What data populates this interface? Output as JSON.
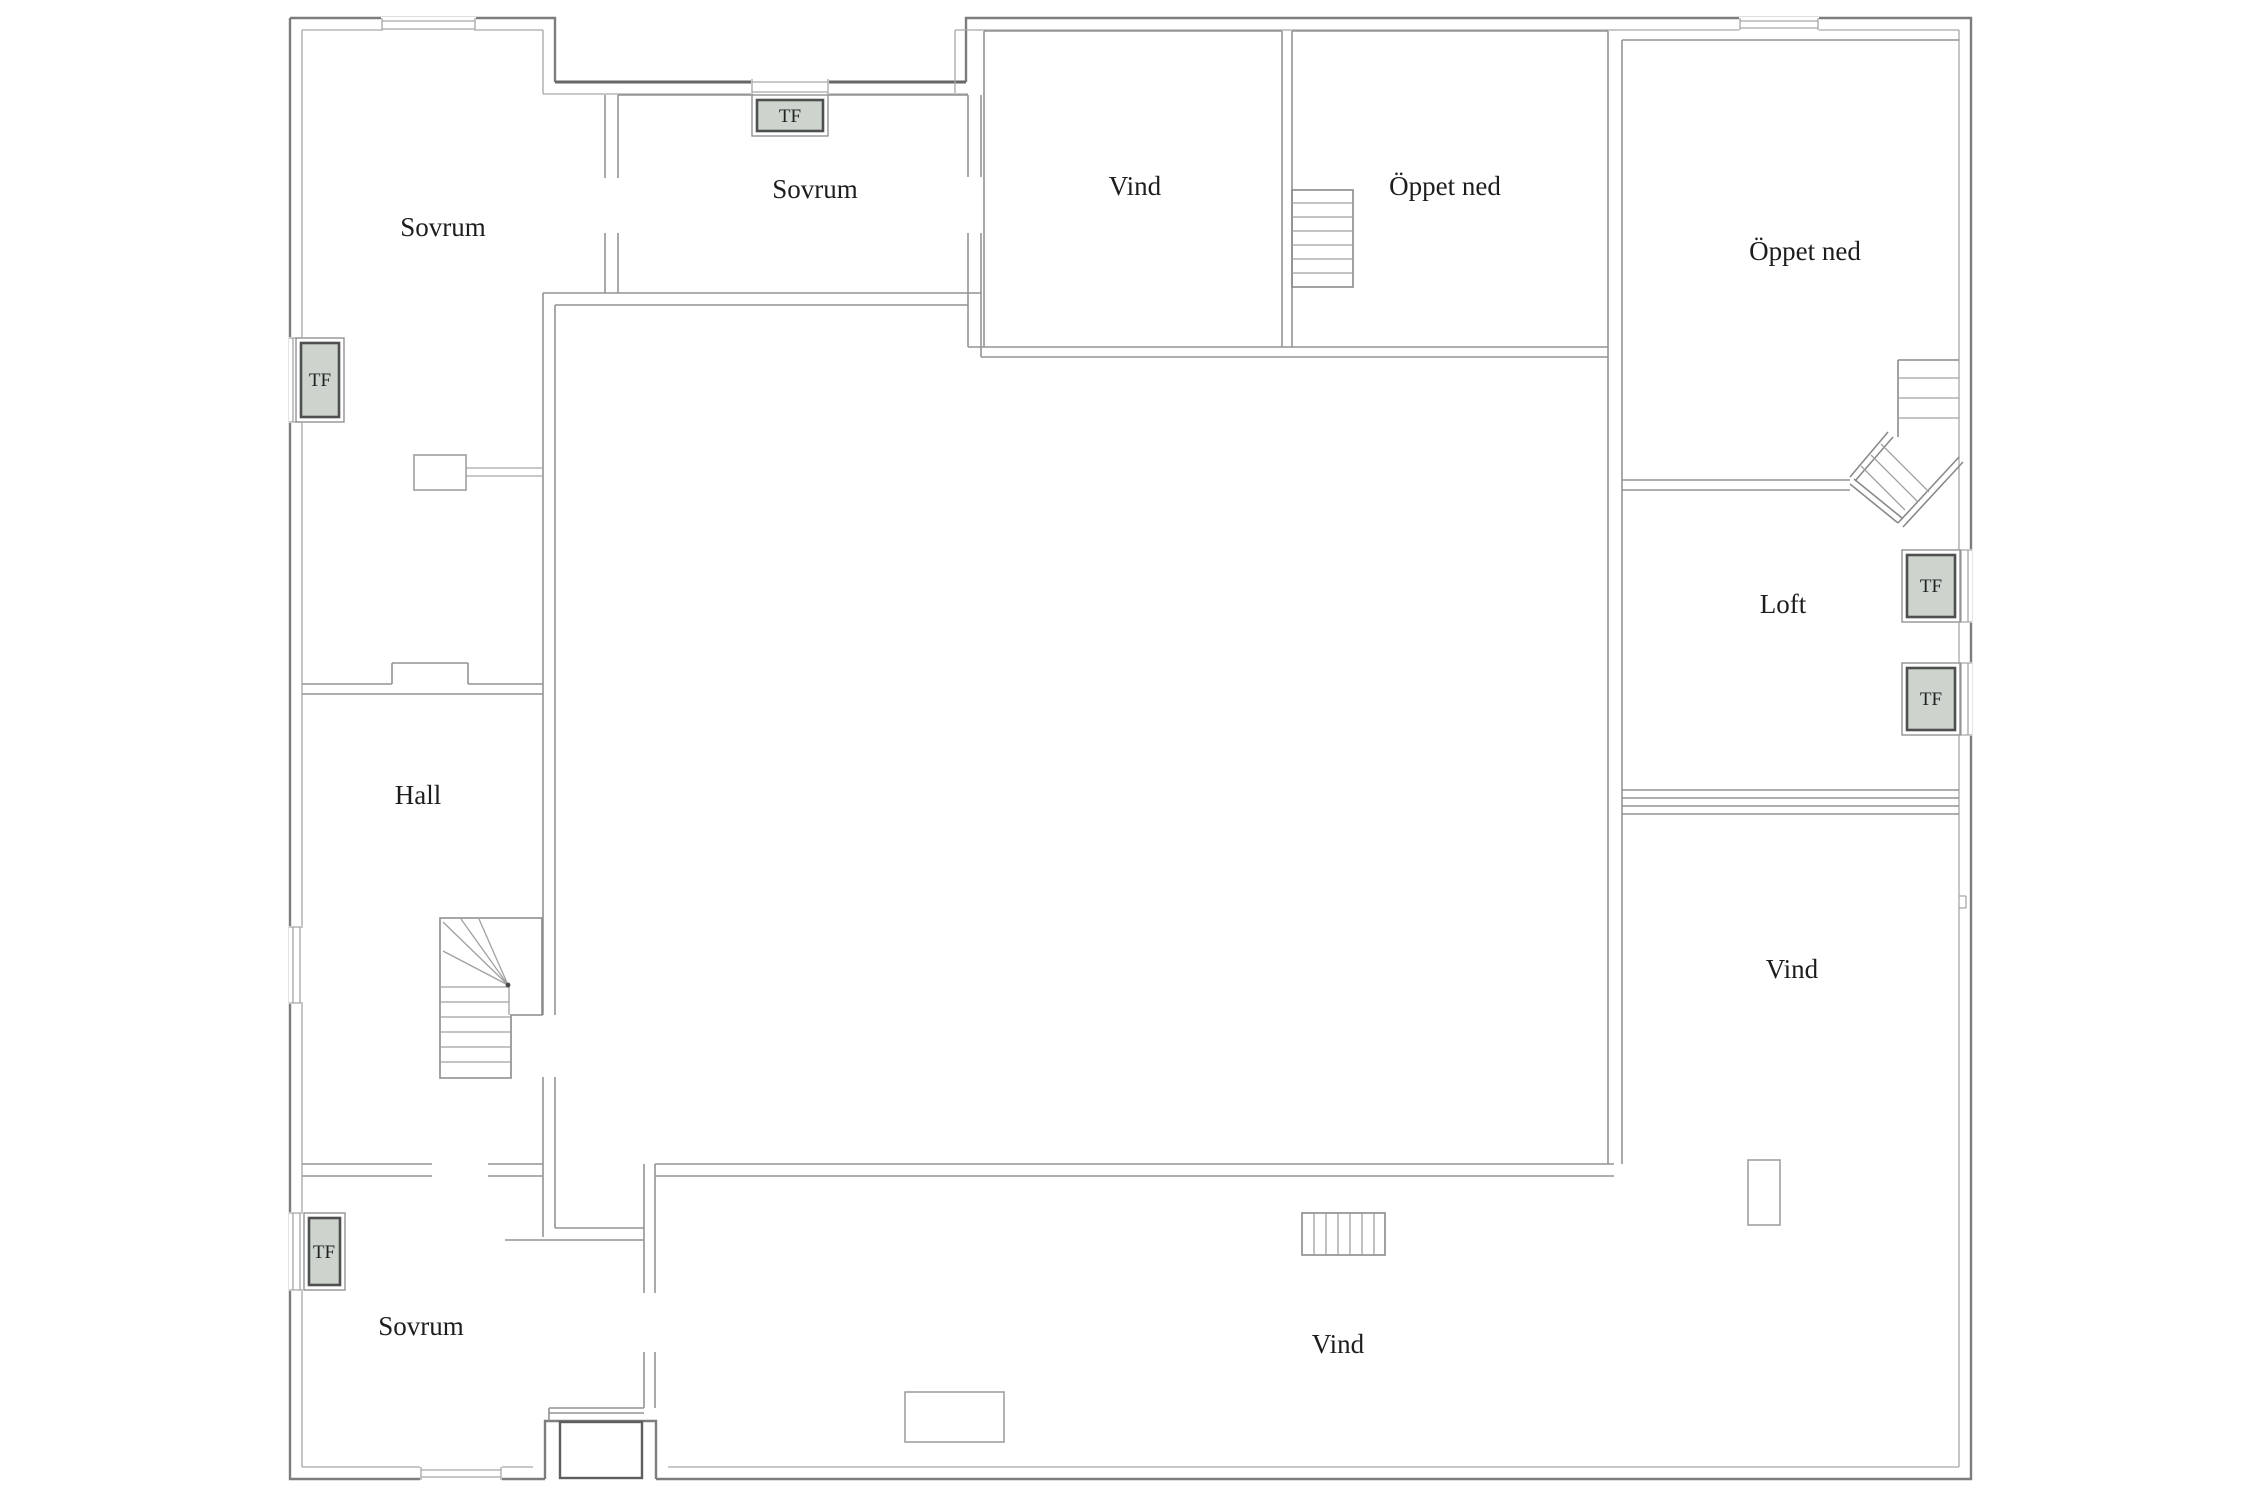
{
  "floorplan": {
    "colors": {
      "wall": "#949494",
      "outline": "#7d7d7d",
      "dark_accent": "#666666",
      "skylight_fill": "#cdd4cd",
      "text": "#1d1d1d"
    },
    "rooms": [
      {
        "id": "sovrum-top-left",
        "label": "Sovrum",
        "x": 443,
        "y": 236
      },
      {
        "id": "sovrum-top-mid",
        "label": "Sovrum",
        "x": 815,
        "y": 198
      },
      {
        "id": "vind-top",
        "label": "Vind",
        "x": 1135,
        "y": 195
      },
      {
        "id": "oppet-ned-top",
        "label": "Öppet ned",
        "x": 1445,
        "y": 195
      },
      {
        "id": "oppet-ned-right",
        "label": "Öppet ned",
        "x": 1805,
        "y": 260
      },
      {
        "id": "loft",
        "label": "Loft",
        "x": 1783,
        "y": 613
      },
      {
        "id": "hall",
        "label": "Hall",
        "x": 418,
        "y": 804
      },
      {
        "id": "sovrum-bottom",
        "label": "Sovrum",
        "x": 421,
        "y": 1335
      },
      {
        "id": "vind-bottom",
        "label": "Vind",
        "x": 1338,
        "y": 1353
      },
      {
        "id": "vind-right",
        "label": "Vind",
        "x": 1792,
        "y": 978
      }
    ],
    "skylights": [
      {
        "id": "tf-left-top",
        "label": "TF",
        "x": 320,
        "y": 386
      },
      {
        "id": "tf-top-mid",
        "label": "TF",
        "x": 790,
        "y": 122
      },
      {
        "id": "tf-left-bottom",
        "label": "TF",
        "x": 324,
        "y": 1258
      },
      {
        "id": "tf-right-upper",
        "label": "TF",
        "x": 1931,
        "y": 592
      },
      {
        "id": "tf-right-lower",
        "label": "TF",
        "x": 1931,
        "y": 705
      }
    ]
  }
}
